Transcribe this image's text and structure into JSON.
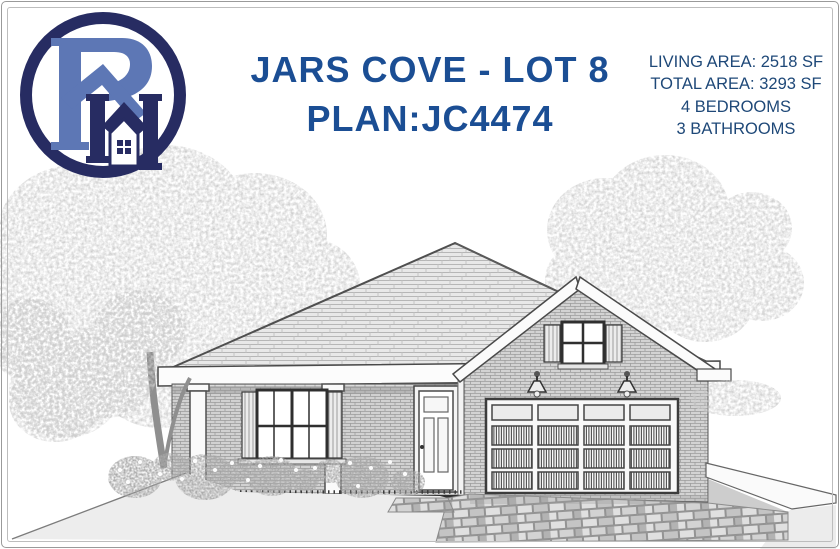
{
  "flyer": {
    "title_line1": "JARS COVE - LOT 8",
    "title_line2": "PLAN:JC4474",
    "specs": {
      "living_area": "LIVING AREA: 2518 SF",
      "total_area": "TOTAL AREA: 3293 SF",
      "bedrooms": "4 BEDROOMS",
      "bathrooms": "3 BATHROOMS"
    }
  },
  "logo": {
    "monogram": "PH",
    "style": "circular ring with stylized P and H forming a house with roof and four-pane window"
  },
  "scene": {
    "description": "Grayscale architectural front elevation: single-story brick home, hip roof, front-facing garage gable with shuttered window, two-car paneled garage door with top window row, two coach lamps, covered porch with square columns, shuttered double window, front door, foundation shrubs with white blossoms, paver driveway and walkway, large deciduous trees behind left and right"
  },
  "colors": {
    "title_blue": "#1b4e94",
    "spec_blue": "#1e4878",
    "logo_navy": "#272c62",
    "logo_blue": "#5d77b5",
    "line_art": "#4a4a4a",
    "brick_gray": "#dadada",
    "ground_gray": "#ededed"
  }
}
